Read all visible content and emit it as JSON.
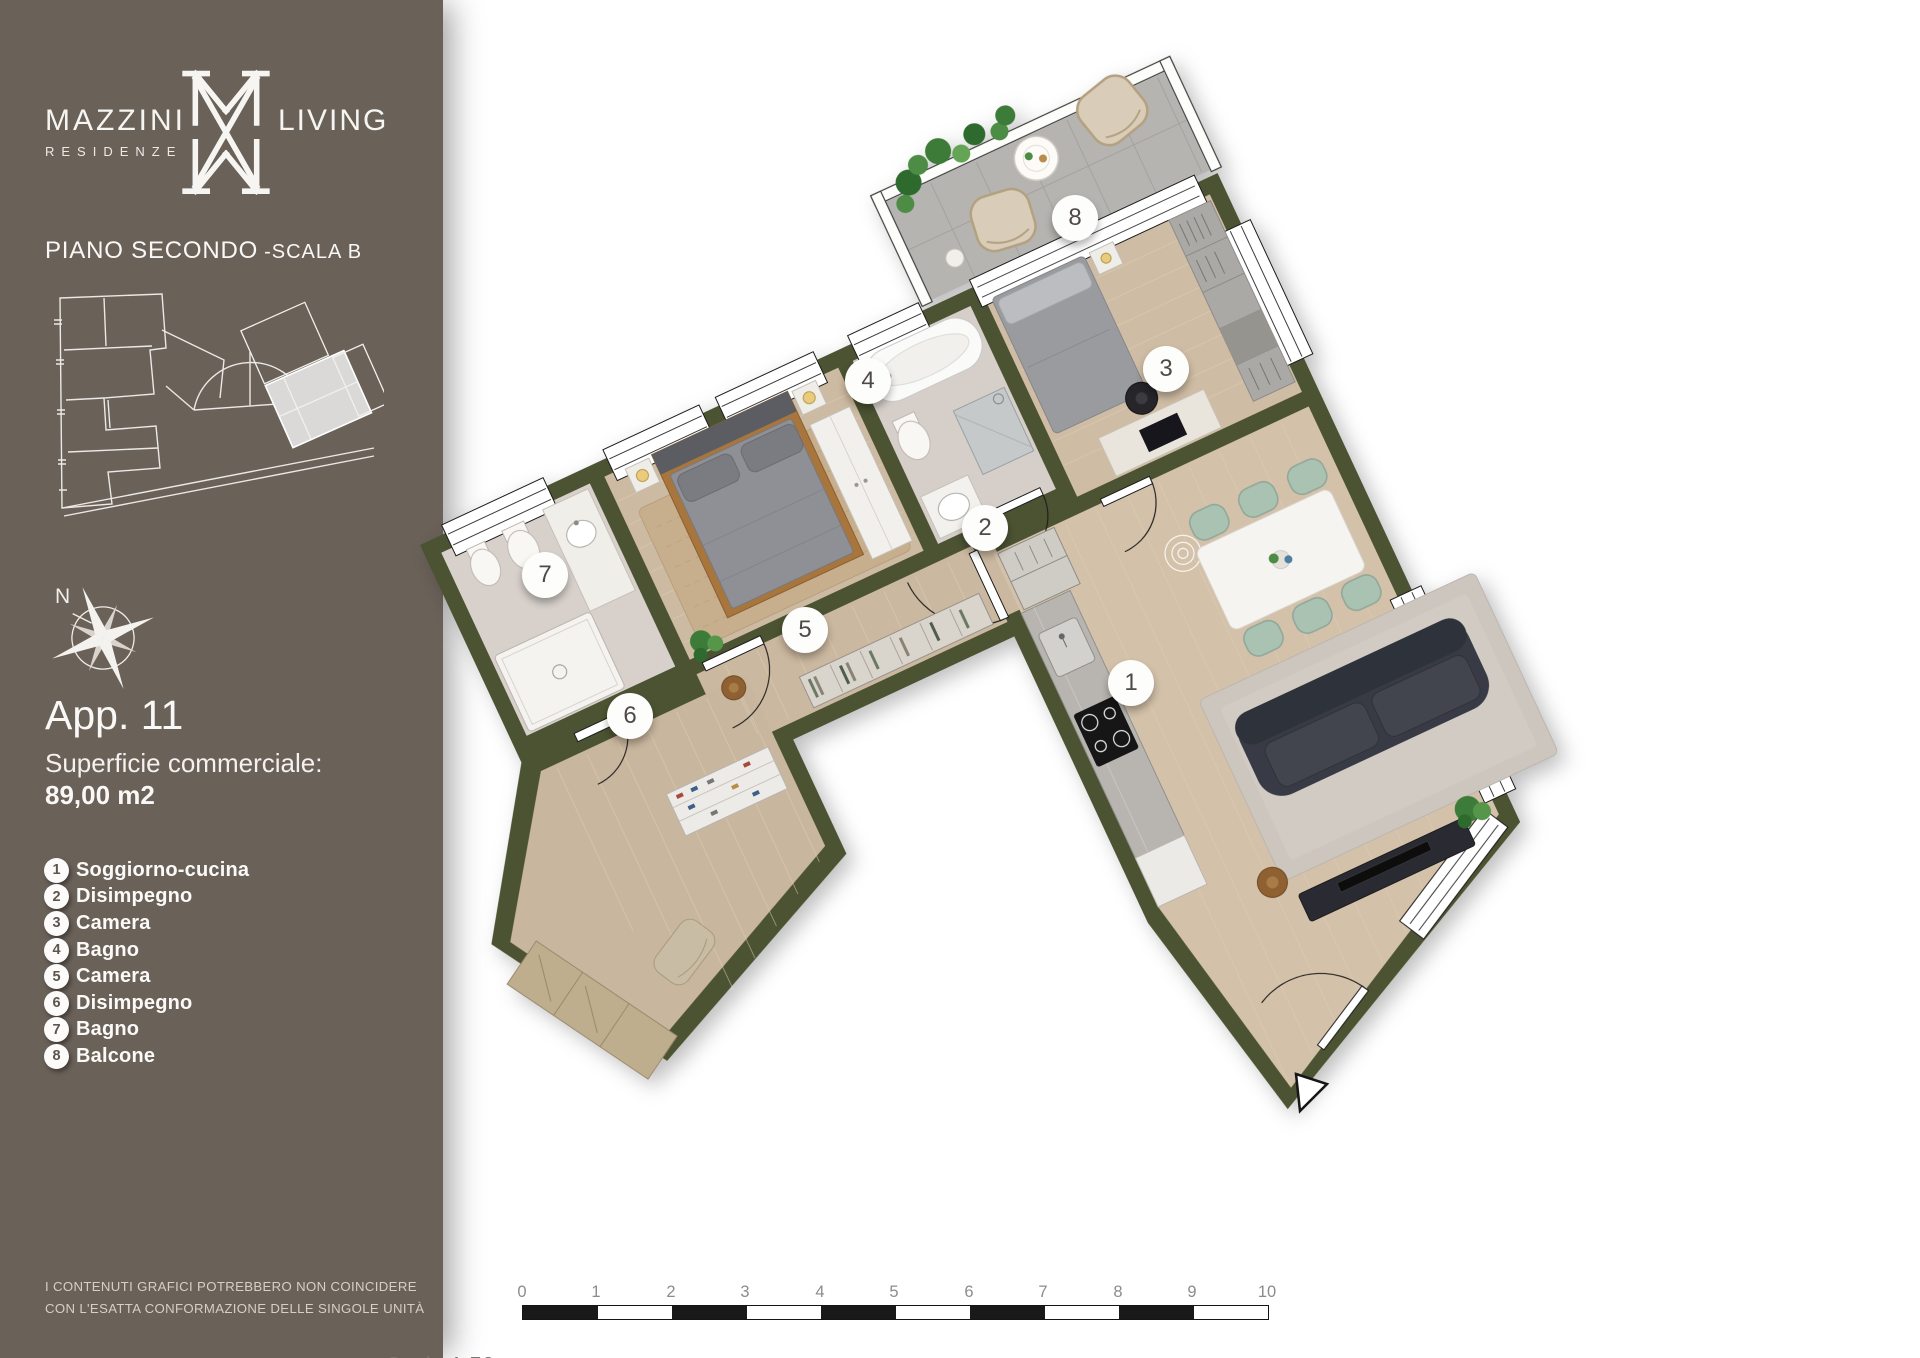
{
  "sidebar": {
    "logo": {
      "brand_left": "MAZZINI",
      "brand_right": "LIVING",
      "subtitle": "RESIDENZE"
    },
    "floor_label": {
      "main": "PIANO SECONDO",
      "suffix": "-SCALA B"
    },
    "compass_north": "N",
    "apartment": {
      "title": "App. 11",
      "area_label": "Superficie commerciale:",
      "area_value": "89,00 m2"
    },
    "legend": {
      "items": [
        {
          "num": "1",
          "label": "Soggiorno-cucina"
        },
        {
          "num": "2",
          "label": "Disimpegno"
        },
        {
          "num": "3",
          "label": "Camera"
        },
        {
          "num": "4",
          "label": "Bagno"
        },
        {
          "num": "5",
          "label": "Camera"
        },
        {
          "num": "6",
          "label": "Disimpegno"
        },
        {
          "num": "7",
          "label": "Bagno"
        },
        {
          "num": "8",
          "label": "Balcone"
        }
      ]
    },
    "footer": {
      "line1": "I CONTENUTI GRAFICI POTREBBERO NON COINCIDERE",
      "line2": "CON L'ESATTA CONFORMAZIONE DELLE SINGOLE UNITÀ"
    }
  },
  "plan": {
    "markers": [
      {
        "num": "1",
        "room": "Soggiorno-cucina"
      },
      {
        "num": "2",
        "room": "Disimpegno"
      },
      {
        "num": "3",
        "room": "Camera"
      },
      {
        "num": "4",
        "room": "Bagno"
      },
      {
        "num": "5",
        "room": "Camera"
      },
      {
        "num": "6",
        "room": "Disimpegno"
      },
      {
        "num": "7",
        "room": "Bagno"
      },
      {
        "num": "8",
        "room": "Balcone"
      }
    ]
  },
  "scalebar": {
    "label": "Scala 1:50",
    "numbers": [
      "0",
      "1",
      "2",
      "3",
      "4",
      "5",
      "6",
      "7",
      "8",
      "9",
      "10"
    ]
  },
  "colors": {
    "sidebar_bg": "#6A6159",
    "wall": "#4B5231",
    "wood_floor": "#CDBAA2",
    "balcony_tile": "#B5B4B0",
    "sage_chair": "#A9C2B1",
    "legend_number": "#5D564E"
  }
}
